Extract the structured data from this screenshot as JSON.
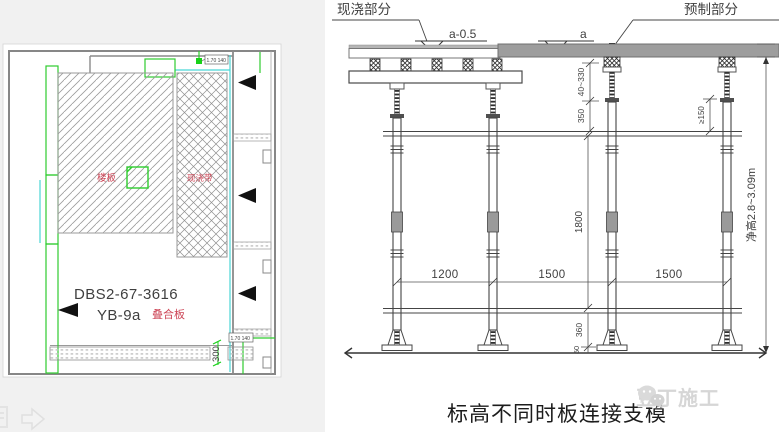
{
  "caption": "标高不同时板连接支模",
  "watermark": {
    "brand": "豆丁施工",
    "icon": "wechat-bubbles-icon"
  },
  "colors": {
    "accent_green": "#22cc22",
    "accent_cyan": "#49d6d6",
    "label_red": "#cc4455",
    "precast_gray": "#9d9d9d"
  },
  "plan": {
    "code_line1": "DBS2-67-3616",
    "code_line2": "YB-9a",
    "label_composite": "叠合板",
    "label_slab": "楼板",
    "label_cast_strip": "现浇带",
    "dim_300": "300",
    "tag_top": "1.70 140",
    "tag_bottom": "1.70 140"
  },
  "elevation": {
    "label_cast": "现浇部分",
    "label_precast": "预制部分",
    "level_cast": "a-0.5",
    "level_precast": "a",
    "dims": {
      "top_adjust": "40~330",
      "top_offset": "350",
      "min_embed": "≥150",
      "span_1": "1200",
      "span_2": "1500",
      "span_3": "1500",
      "mid_height": "1800",
      "bottom_offset": "360",
      "base": "50",
      "clear_height": "净高2.8~3.09m"
    }
  }
}
